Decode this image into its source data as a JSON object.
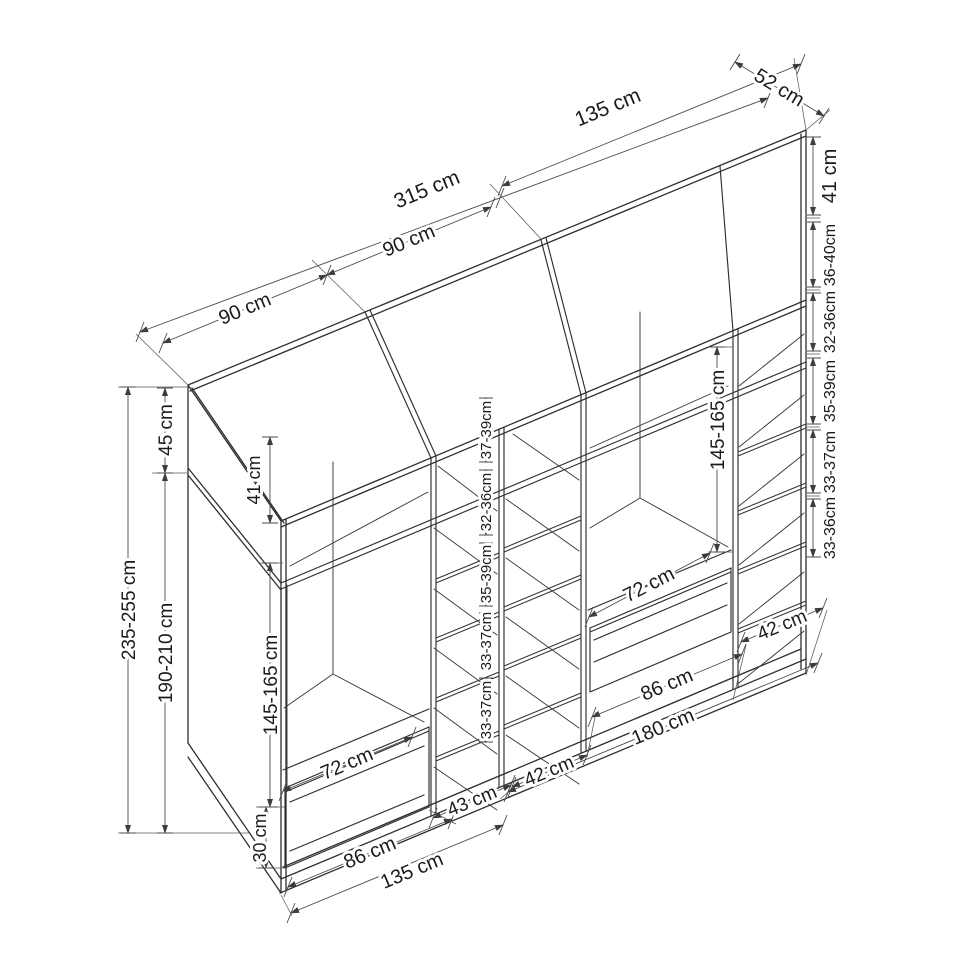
{
  "diagram": {
    "type": "wardrobe-dimension-drawing",
    "unit": "cm",
    "top_dims": {
      "seg_left": "90 cm",
      "seg_mid": "90 cm",
      "total_width": "315 cm",
      "right_width": "135 cm",
      "depth": "52 cm"
    },
    "right_dims": {
      "top_shelf": "41 cm",
      "shelf1": "36-40cm",
      "shelf2": "32-36cm",
      "shelf3": "35-39cm",
      "shelf4": "33-37cm",
      "shelf5": "33-36cm"
    },
    "left_dims": {
      "total_height": "235-255 cm",
      "top_box": "45 cm",
      "body_height": "190-210 cm",
      "top_box_inner": "41 cm",
      "hanging": "145-165 cm",
      "drawer": "30 cm"
    },
    "center_dims": {
      "shelf1": "37-39cm",
      "shelf2": "32-36cm",
      "shelf3": "35-39cm",
      "shelf4": "33-37cm",
      "shelf5": "33-37cm"
    },
    "interior_dims": {
      "right_hanging": "145-165 cm",
      "left_drawer_width": "72 cm",
      "right_drawer_width": "72 cm"
    },
    "bottom_dims": {
      "left_section": "86 cm",
      "left_total": "135 cm",
      "mid_col_a": "43 cm",
      "mid_col_b": "42 cm",
      "right_section": "86 cm",
      "right_total": "180 cm",
      "right_col": "42 cm"
    }
  }
}
